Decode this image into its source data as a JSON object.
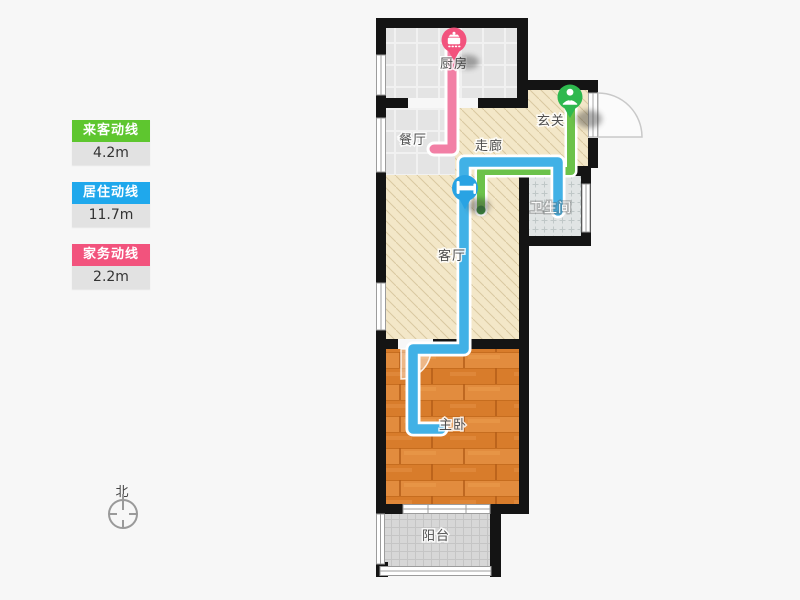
{
  "legend": {
    "items": [
      {
        "label": "来客动线",
        "value": "4.2m",
        "color": "#5EC62F"
      },
      {
        "label": "居住动线",
        "value": "11.7m",
        "color": "#1FA8EC"
      },
      {
        "label": "家务动线",
        "value": "2.2m",
        "color": "#F2537D"
      }
    ]
  },
  "compass": {
    "label": "北"
  },
  "rooms": {
    "kitchen": "厨房",
    "dining": "餐厅",
    "corridor": "走廊",
    "entry": "玄关",
    "bathroom": "卫生间",
    "living": "客厅",
    "bedroom": "主卧",
    "balcony": "阳台"
  },
  "lines": {
    "guest": {
      "name": "来客动线",
      "length": "4.2m",
      "color": "#6CC24A",
      "end_color": "#358A39",
      "pin_color": "#2EB84E",
      "pin_icon": "person-icon"
    },
    "resident": {
      "name": "居住动线",
      "length": "11.7m",
      "color": "#41B1E6",
      "pin_color": "#29A3E3",
      "pin_icon": "bed-icon"
    },
    "housework": {
      "name": "家务动线",
      "length": "2.2m",
      "color": "#F27FA5",
      "pin_color": "#F2537D",
      "pin_icon": "pot-icon"
    }
  }
}
